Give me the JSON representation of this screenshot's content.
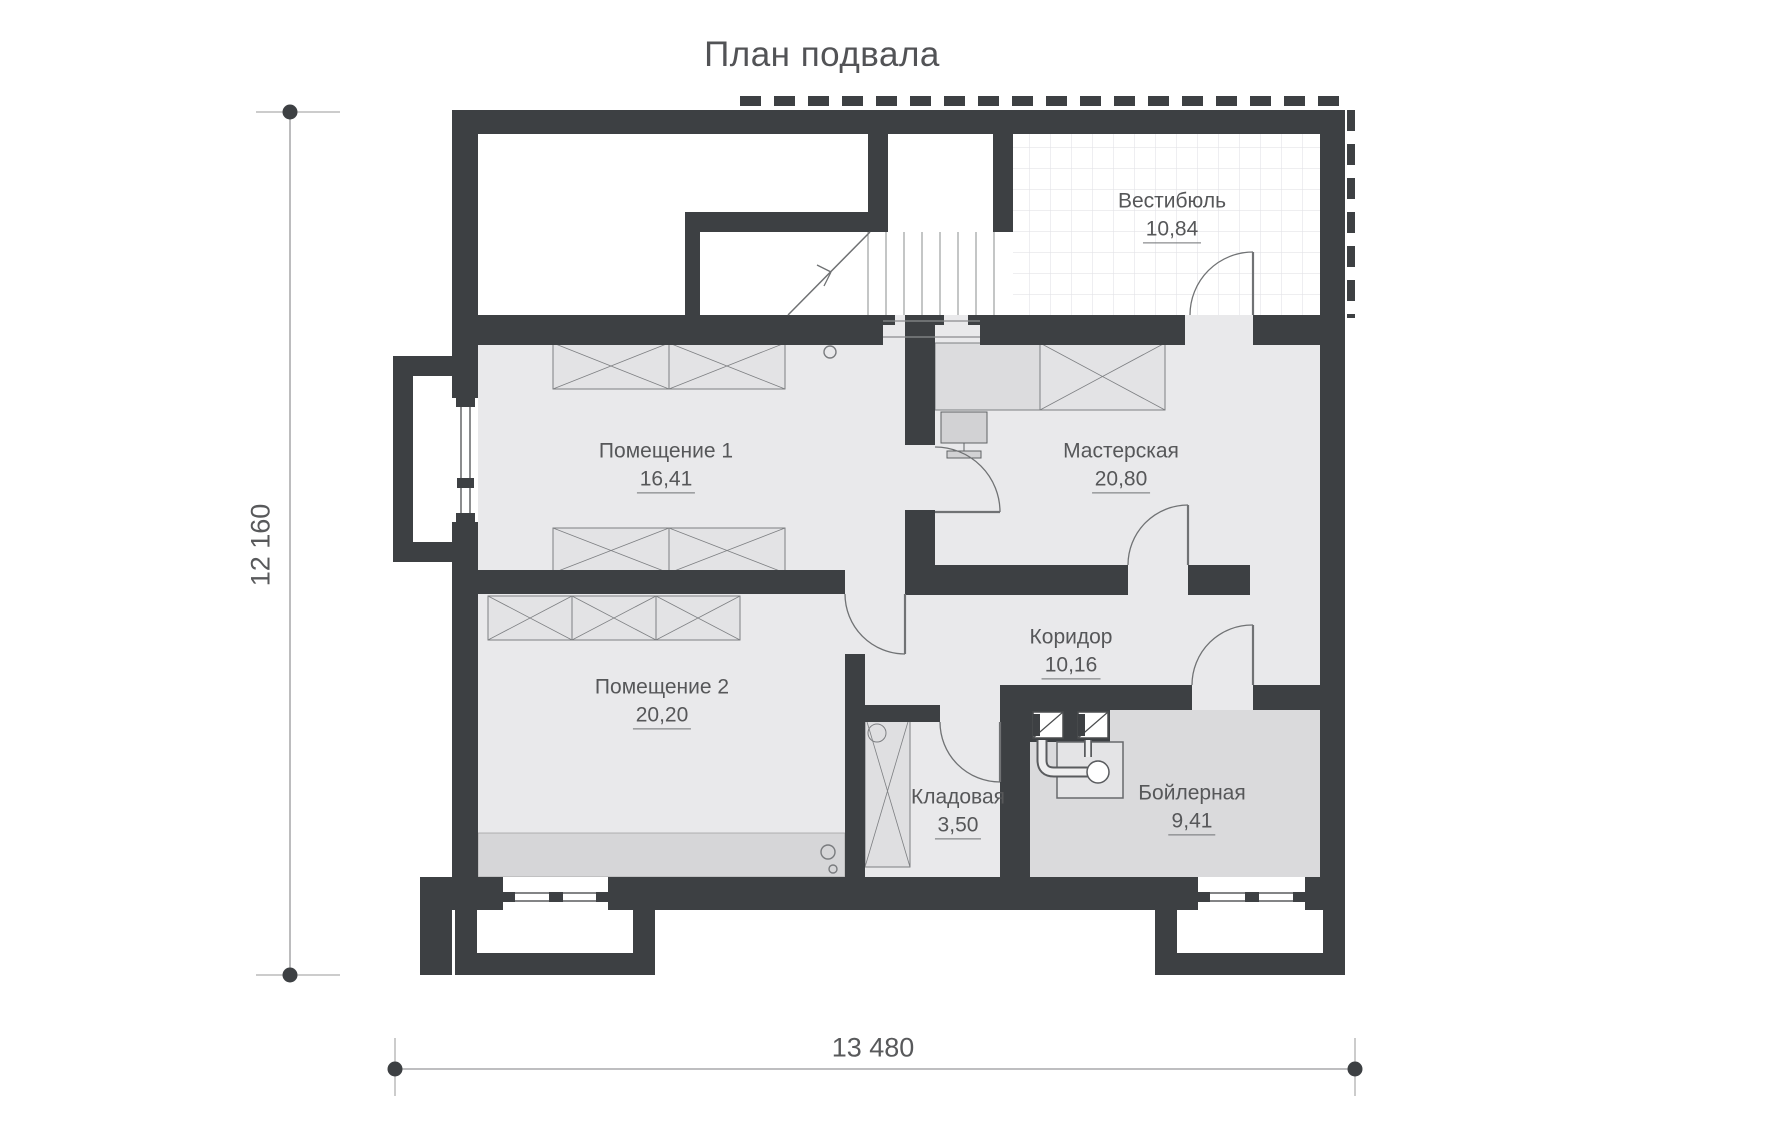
{
  "title": "План подвала",
  "plan": {
    "rooms": [
      {
        "id": "vestibule",
        "name": "Вестибюль",
        "area": "10,84"
      },
      {
        "id": "room1",
        "name": "Помещение 1",
        "area": "16,41"
      },
      {
        "id": "workshop",
        "name": "Мастерская",
        "area": "20,80"
      },
      {
        "id": "room2",
        "name": "Помещение 2",
        "area": "20,20"
      },
      {
        "id": "corridor",
        "name": "Коридор",
        "area": "10,16"
      },
      {
        "id": "storage",
        "name": "Кладовая",
        "area": "3,50"
      },
      {
        "id": "boiler",
        "name": "Бойлерная",
        "area": "9,41"
      }
    ],
    "dimensions": {
      "horizontal": "13 480",
      "vertical": "12 160"
    },
    "colors": {
      "wall": "#3d4043",
      "floor": "#e9e9eb",
      "boiler_floor": "#dadadc",
      "furniture": "#e3e3e5",
      "text": "#565759",
      "dimension_marker": "#3d4043"
    }
  }
}
